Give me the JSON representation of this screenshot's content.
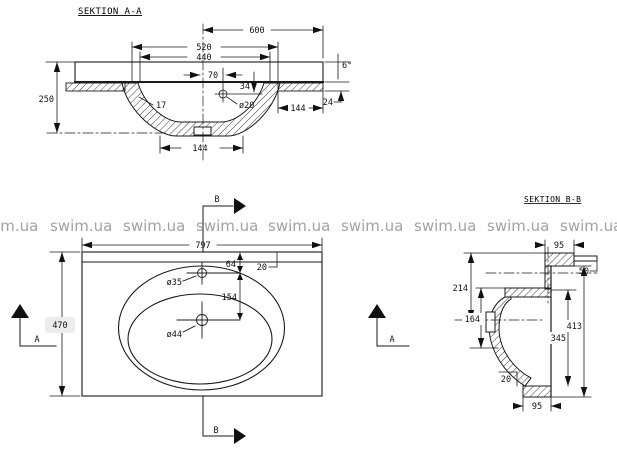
{
  "colors": {
    "line": "#1a1a1a",
    "watermark": "#9b9b9b"
  },
  "watermark": {
    "text": "swim.ua"
  },
  "section_aa": {
    "title": "SEKTION A-A",
    "dims": {
      "width_top": "600",
      "width_520": "520",
      "width_440": "440",
      "offset_70": "70",
      "height_250": "250",
      "wall_17": "17",
      "hole": "ø20",
      "depth_34": "34",
      "right_144": "144",
      "edge_24": "24",
      "angle_6": "6°",
      "bottom_144": "144"
    }
  },
  "plan": {
    "dims": {
      "width": "797",
      "depth": "470",
      "faucet_offset": "64",
      "drain_offset": "154",
      "edge_20": "20",
      "faucet_hole": "ø35",
      "drain_hole": "ø44"
    },
    "cut_labels": {
      "a": "A",
      "b": "B"
    }
  },
  "section_bb": {
    "title": "SEKTION B-B",
    "dims": {
      "top_95": "95",
      "lip_50": "50",
      "back_214": "214",
      "bowl_164": "164",
      "inner_345": "345",
      "total_413": "413",
      "bottom_20": "20",
      "bottom_95": "95"
    }
  }
}
